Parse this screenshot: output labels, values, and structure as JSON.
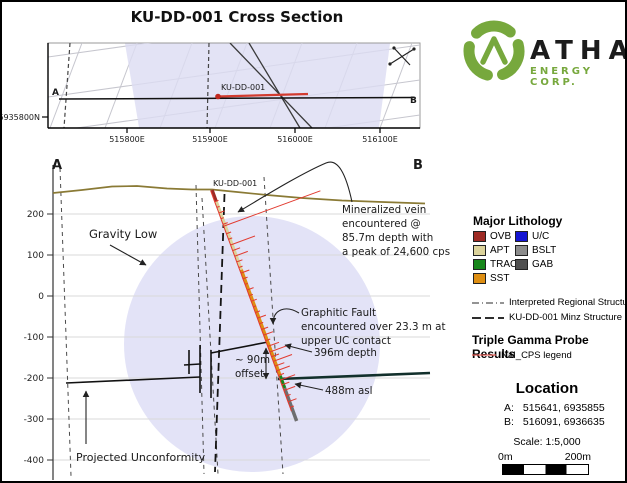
{
  "title": "KU-DD-001 Cross Section",
  "logo": {
    "company": "ATHA",
    "tagline": "ENERGY CORP.",
    "brand_green": "#77A83D"
  },
  "map": {
    "a": "A",
    "b": "B",
    "hole": "KU-DD-001",
    "northing": "6935800N",
    "eastings": [
      "515800E",
      "515900E",
      "516000E",
      "516100E"
    ]
  },
  "section": {
    "a": "A",
    "b": "B",
    "hole": "KU-DD-001",
    "elevations": [
      "200",
      "100",
      "0",
      "-100",
      "-200",
      "-300",
      "-400"
    ],
    "gravity_low": "Gravity Low",
    "vein_note": [
      "Mineralized vein",
      "encountered @",
      "85.7m depth with",
      "a peak of 24,600 cps"
    ],
    "fault_note": [
      "Graphitic Fault",
      "encountered  over 23.3 m at",
      "upper UC contact"
    ],
    "depth_note": "396m depth",
    "offset_note": [
      "~ 90m",
      "offset"
    ],
    "asl_note": "488m asl",
    "unconformity_note": "Projected Unconformity"
  },
  "legend": {
    "lithology_title": "Major Lithology",
    "lithology": [
      {
        "code": "OVB",
        "color": "#9E2B25"
      },
      {
        "code": "U/C",
        "color": "#1414D2"
      },
      {
        "code": "APT",
        "color": "#DCD39B"
      },
      {
        "code": "BSLT",
        "color": "#8C8C8C"
      },
      {
        "code": "TRAC",
        "color": "#17871B"
      },
      {
        "code": "GAB",
        "color": "#4F4F4F"
      },
      {
        "code": "SST",
        "color": "#DE8E12"
      }
    ],
    "structures": [
      {
        "label": "Interpreted Regional Structure"
      },
      {
        "label": "KU-DD-001 Minz Structure"
      }
    ],
    "gamma_title": "Triple Gamma  Probe Results",
    "gamma_item": "NaI_CPS legend",
    "location_title": "Location",
    "location_rows": [
      {
        "label": "A:",
        "value": "515641, 6935855"
      },
      {
        "label": "B:",
        "value": "516091, 6936635"
      }
    ],
    "scale_text": "Scale: 1:5,000",
    "scalebar_left": "0m",
    "scalebar_right": "200m"
  },
  "colors": {
    "shading_lavender": "#DEDEF6",
    "gamma_red": "#E23B30",
    "topo_olive": "#8A7A35",
    "brand_green": "#77A83D"
  }
}
